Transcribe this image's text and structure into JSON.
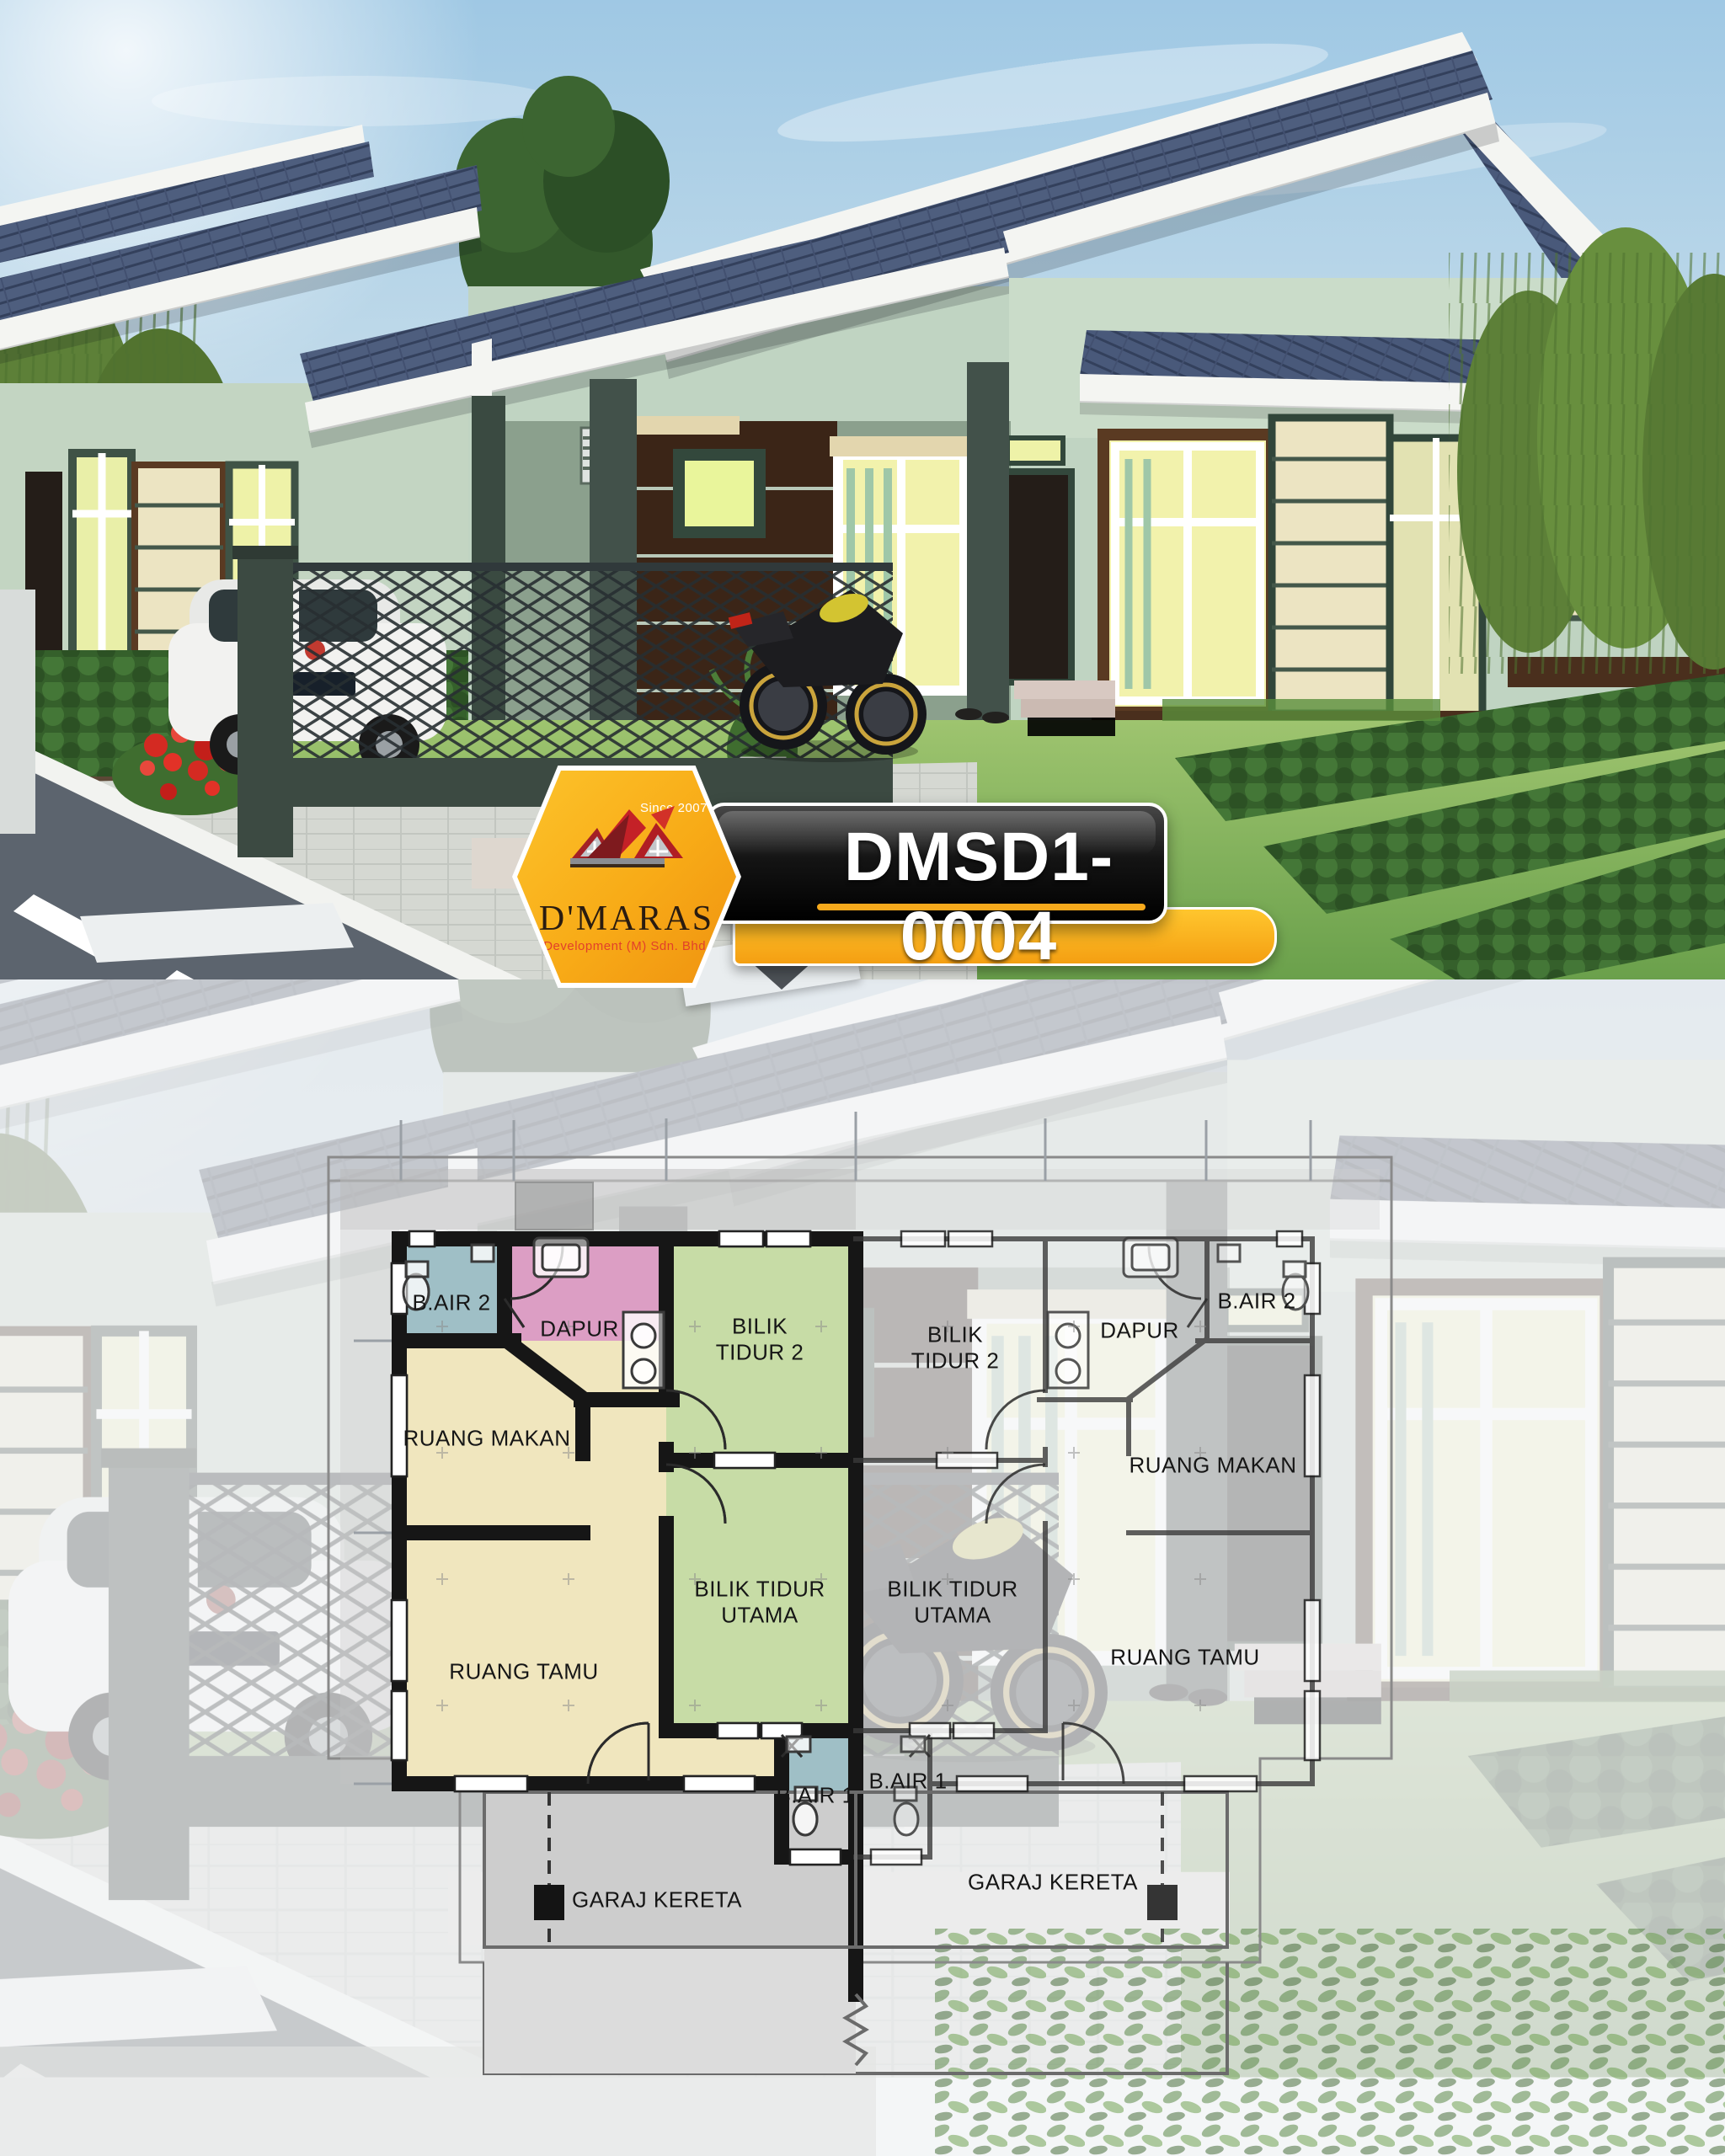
{
  "badge": {
    "code": "DMSD1-0004",
    "logo": {
      "name": "D'MARAS",
      "since": "Since 2007",
      "tagline": "Development (M) Sdn. Bhd."
    },
    "colors": {
      "yellow": "#F8AB17",
      "banner_black": "#141414",
      "logo_red": "#C2202A",
      "code_text": "#FFFFFF"
    }
  },
  "floor_plan": {
    "wall_color": "#161616",
    "left_unit": {
      "rooms": [
        {
          "id": "bair2",
          "label": "B.AIR 2",
          "fill": "#9FBFC6"
        },
        {
          "id": "dapur",
          "label": "DAPUR",
          "fill": "#DC9EC4"
        },
        {
          "id": "bilik2",
          "label": "BILIK TIDUR 2",
          "fill": "#C7DCA6"
        },
        {
          "id": "makan",
          "label": "RUANG MAKAN",
          "fill": "#F0E6BE"
        },
        {
          "id": "utama",
          "label": "BILIK TIDUR UTAMA",
          "fill": "#C7DCA6"
        },
        {
          "id": "tamu",
          "label": "RUANG TAMU",
          "fill": "#F0E6BE"
        },
        {
          "id": "bair1",
          "label": "B.AIR 1",
          "fill": "#9FBFC6"
        },
        {
          "id": "garaj",
          "label": "GARAJ KERETA",
          "fill": "#CDCDCD"
        }
      ]
    },
    "right_unit": {
      "rooms": [
        {
          "id": "bair2",
          "label": "B.AIR 2"
        },
        {
          "id": "dapur",
          "label": "DAPUR"
        },
        {
          "id": "bilik2",
          "label": "BILIK TIDUR 2"
        },
        {
          "id": "makan",
          "label": "RUANG MAKAN"
        },
        {
          "id": "utama",
          "label": "BILIK TIDUR UTAMA"
        },
        {
          "id": "tamu",
          "label": "RUANG TAMU"
        },
        {
          "id": "bair1",
          "label": "B.AIR 1"
        },
        {
          "id": "garaj",
          "label": "GARAJ KERETA"
        }
      ]
    }
  },
  "hero": {
    "colors": {
      "sky_top": "#9FC8E4",
      "sky_bottom": "#E9F1F2",
      "roof_tile": "#4E5E7E",
      "fascia_white": "#F4F5F2",
      "wall_sage": "#C0D4C2",
      "wall_accent_brown": "#3B2517",
      "window_glow": "#F2F2AC",
      "window_blind_green": "#9FC7A8",
      "column_green": "#42514A",
      "lawn_green": "#7FB357",
      "hedge_green": "#3C7231",
      "road_gray": "#5C646E"
    }
  }
}
